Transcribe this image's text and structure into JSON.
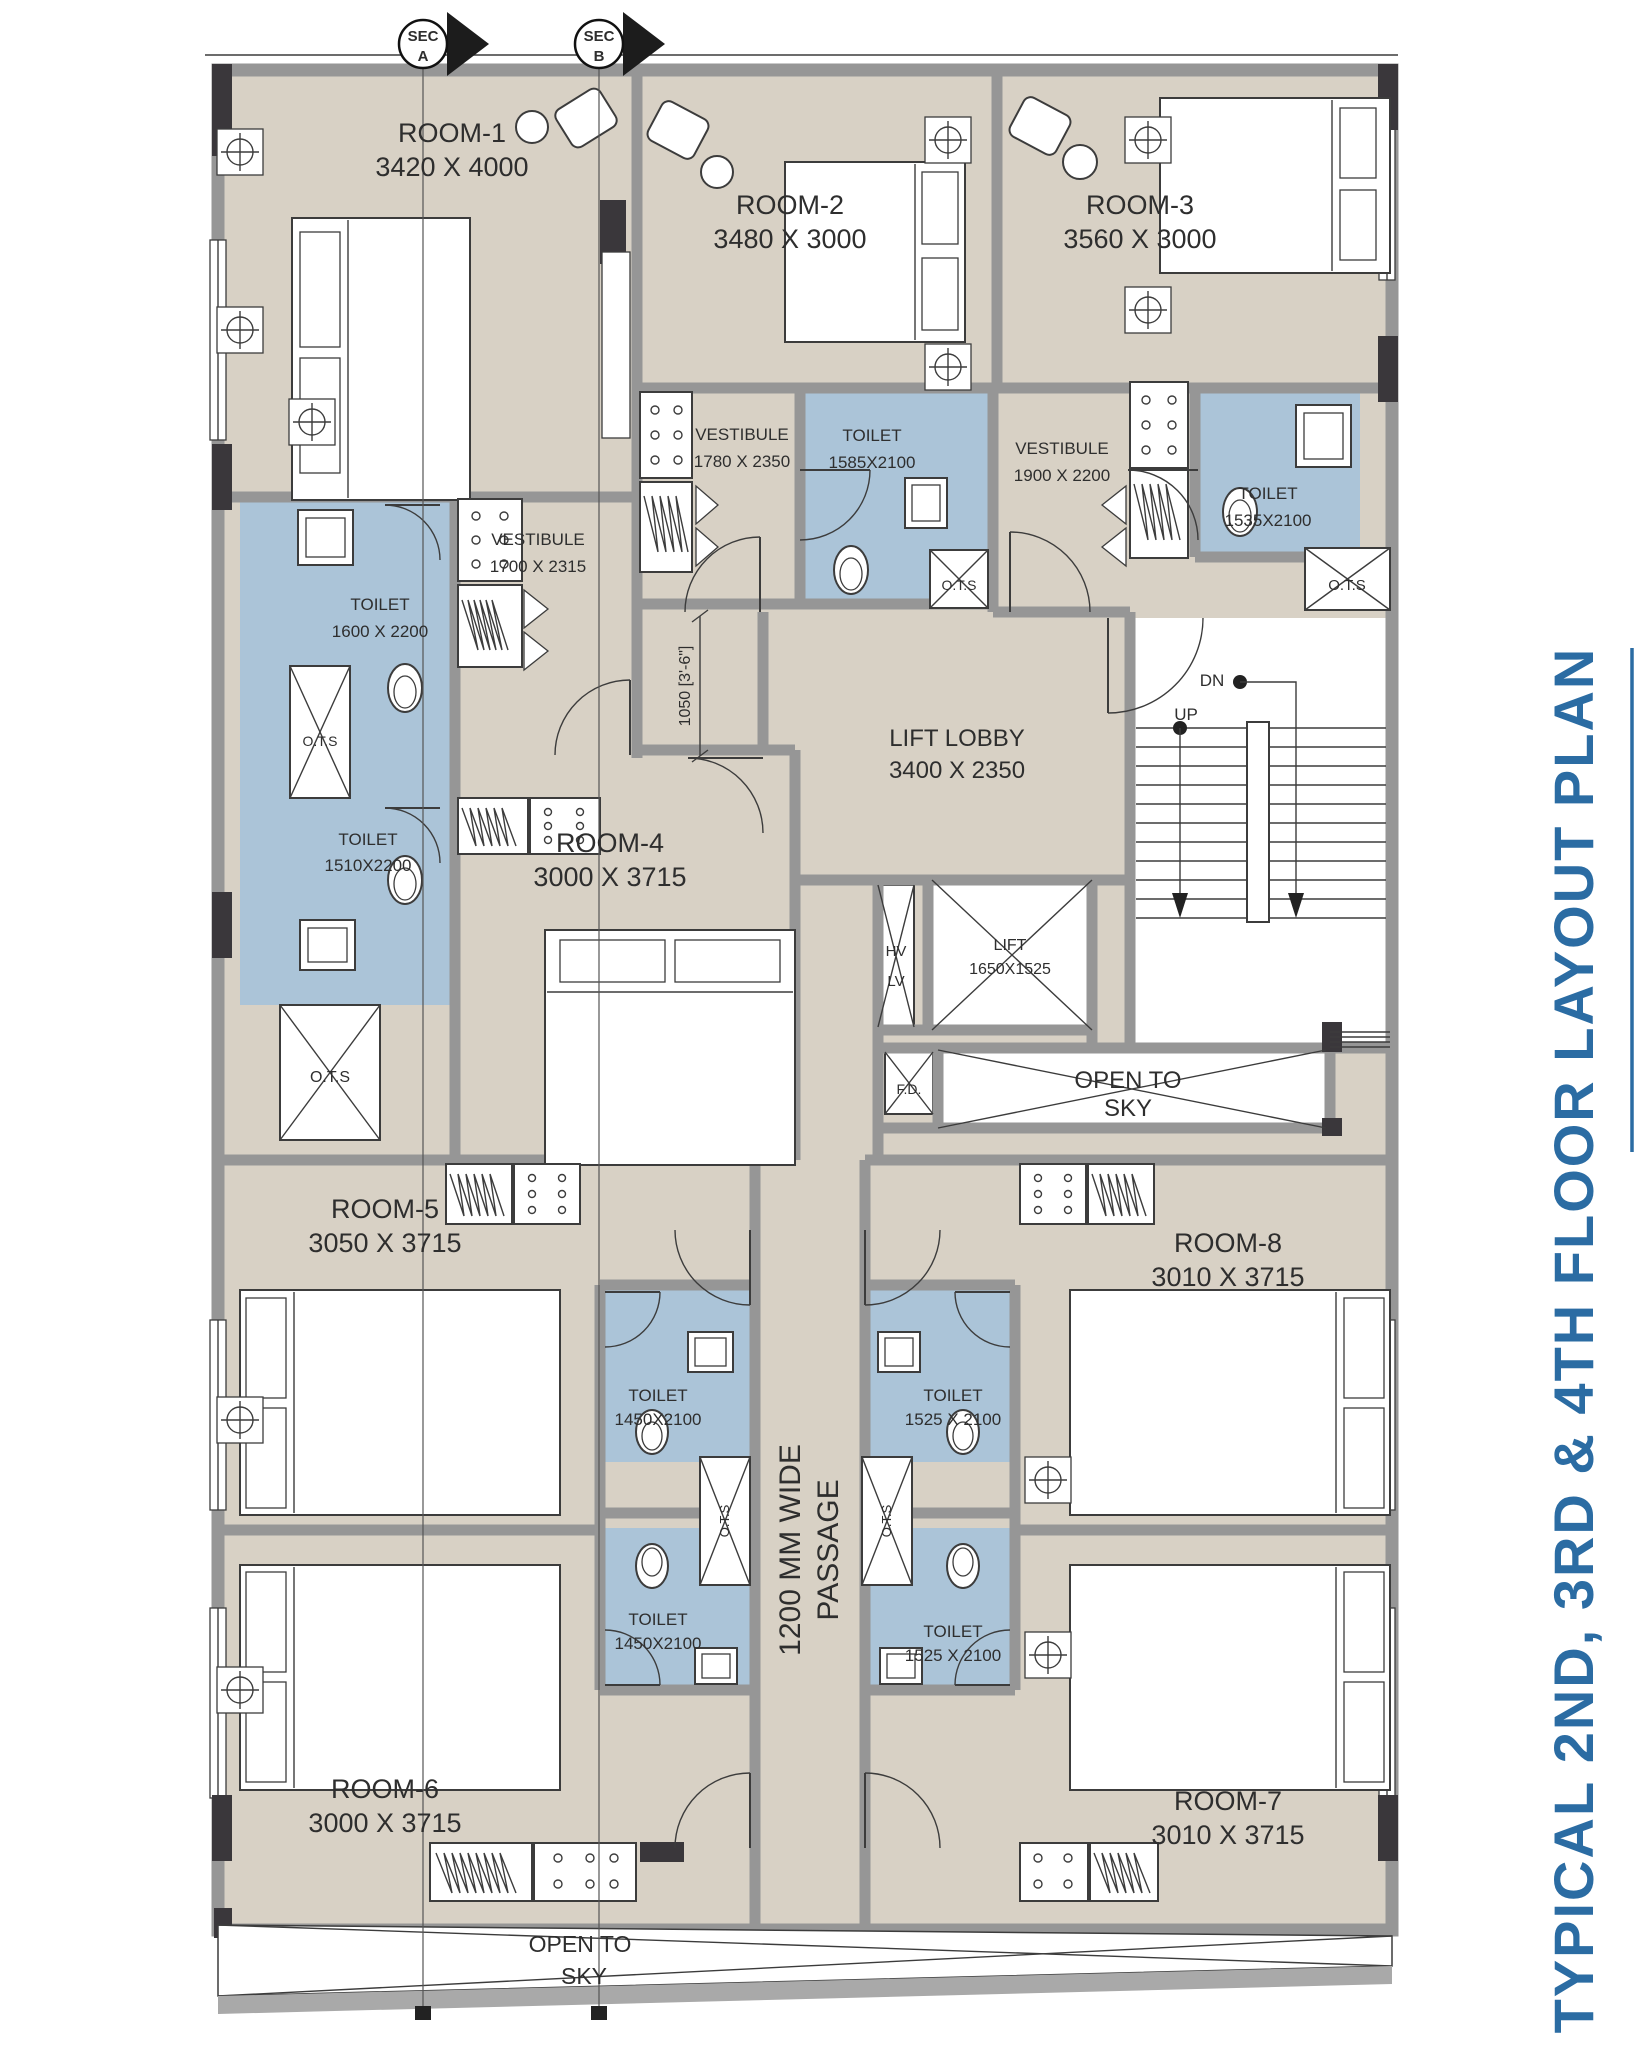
{
  "title": {
    "text": "TYPICAL 2ND, 3RD & 4TH FLOOR LAYOUT PLAN"
  },
  "section_markers": {
    "a": {
      "top": "SEC",
      "bottom": "A"
    },
    "b": {
      "top": "SEC",
      "bottom": "B"
    }
  },
  "rooms": [
    {
      "name": "ROOM-1",
      "dim": "3420 X 4000"
    },
    {
      "name": "ROOM-2",
      "dim": "3480 X 3000"
    },
    {
      "name": "ROOM-3",
      "dim": "3560 X 3000"
    },
    {
      "name": "ROOM-4",
      "dim": "3000 X 3715"
    },
    {
      "name": "ROOM-5",
      "dim": "3050 X 3715"
    },
    {
      "name": "ROOM-6",
      "dim": "3000 X 3715"
    },
    {
      "name": "ROOM-7",
      "dim": "3010 X 3715"
    },
    {
      "name": "ROOM-8",
      "dim": "3010 X 3715"
    }
  ],
  "vestibules": [
    {
      "name": "VESTIBULE",
      "dim": "1700 X 2315"
    },
    {
      "name": "VESTIBULE",
      "dim": "1780 X 2350"
    },
    {
      "name": "VESTIBULE",
      "dim": "1900 X 2200"
    }
  ],
  "toilets": [
    {
      "name": "TOILET",
      "dim": "1600 X 2200"
    },
    {
      "name": "TOILET",
      "dim": "1510X2200"
    },
    {
      "name": "TOILET",
      "dim": "1585X2100"
    },
    {
      "name": "TOILET",
      "dim": "1535X2100"
    },
    {
      "name": "TOILET",
      "dim": "1450X2100"
    },
    {
      "name": "TOILET",
      "dim": "1450X2100"
    },
    {
      "name": "TOILET",
      "dim": "1525 X 2100"
    },
    {
      "name": "TOILET",
      "dim": "1525 X 2100"
    }
  ],
  "lift_lobby": {
    "name": "LIFT LOBBY",
    "dim": "3400 X 2350"
  },
  "lift": {
    "name": "LIFT",
    "dim": "1650X1525"
  },
  "stairs": {
    "down": "DN",
    "up": "UP"
  },
  "labels": {
    "ots": "O.T.S",
    "fd": "F.D.",
    "hv": "HV",
    "lv": "LV"
  },
  "open_to_sky": {
    "line1": "OPEN TO",
    "line2": "SKY"
  },
  "passage": {
    "line1": "1200 MM WIDE",
    "line2": "PASSAGE"
  },
  "dimension": {
    "lobby_clearance": "1050 [3'-6\"]"
  },
  "colors": {
    "floor": "#d8d1c5",
    "toilet": "#abc4d8",
    "wall": "#969696",
    "column": "#3a373b",
    "line": "#3c3c3c",
    "title_blue": "#2b6ca3"
  }
}
